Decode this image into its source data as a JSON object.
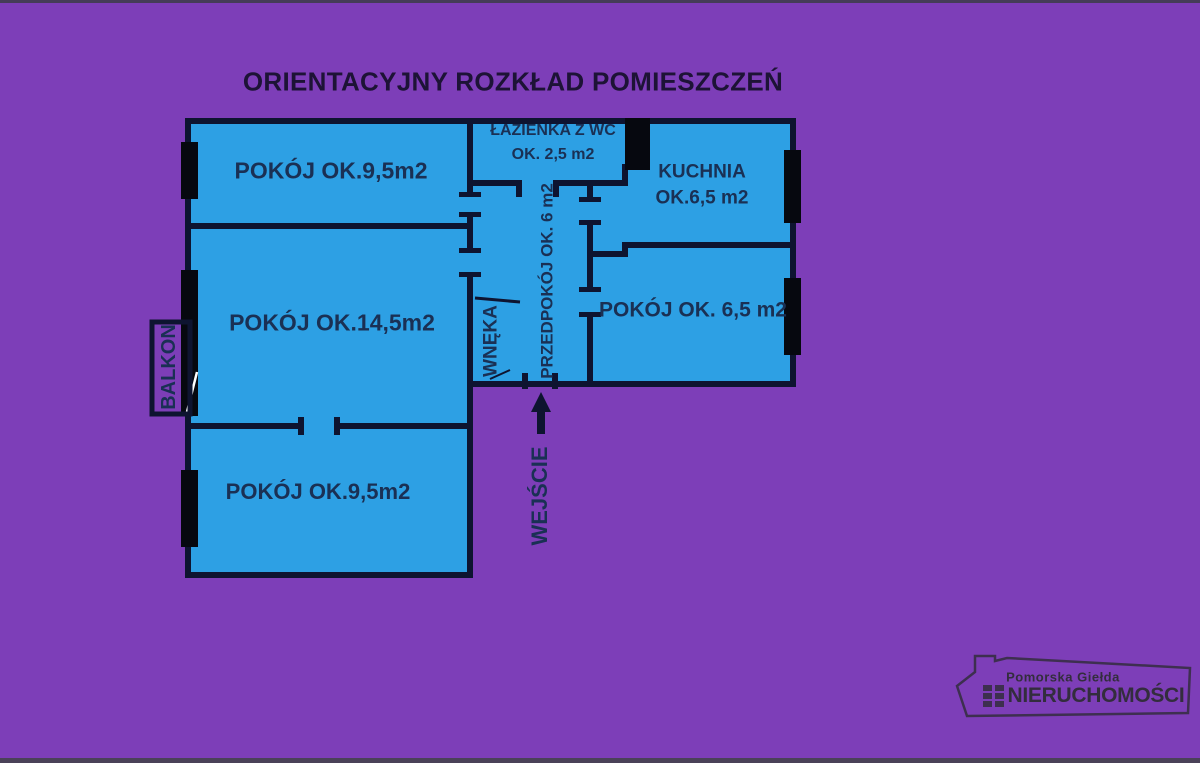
{
  "title": "ORIENTACYJNY ROZKŁAD POMIESZCZEŃ",
  "floorplan": {
    "rooms": {
      "room_top_left": {
        "label": "POKÓJ OK.9,5m2"
      },
      "bathroom": {
        "name": "ŁAZIENKA Z WC",
        "area": "OK. 2,5 m2"
      },
      "kitchen": {
        "name": "KUCHNIA",
        "area": "OK.6,5 m2"
      },
      "room_middle_left": {
        "label": "POKÓJ OK.14,5m2"
      },
      "hallway": {
        "label": "PRZEDPOKÓJ OK. 6 m2"
      },
      "niche": {
        "label": "WNĘKA"
      },
      "room_right": {
        "label": "POKÓJ OK. 6,5 m2"
      },
      "room_bottom_left": {
        "label": "POKÓJ OK.9,5m2"
      },
      "balcony": {
        "label": "BALKON"
      },
      "entrance": {
        "label": "WEJŚCIE"
      }
    },
    "colors": {
      "background": "#7d3eb8",
      "room_fill": "#2da0e4",
      "walls": "#0e1430",
      "windows": "#06080f",
      "label_text": "#1a3054",
      "title_text": "#1d1336"
    }
  },
  "logo": {
    "top_line": "Pomorska Giełda",
    "bottom_line": "NIERUCHOMOŚCI"
  }
}
